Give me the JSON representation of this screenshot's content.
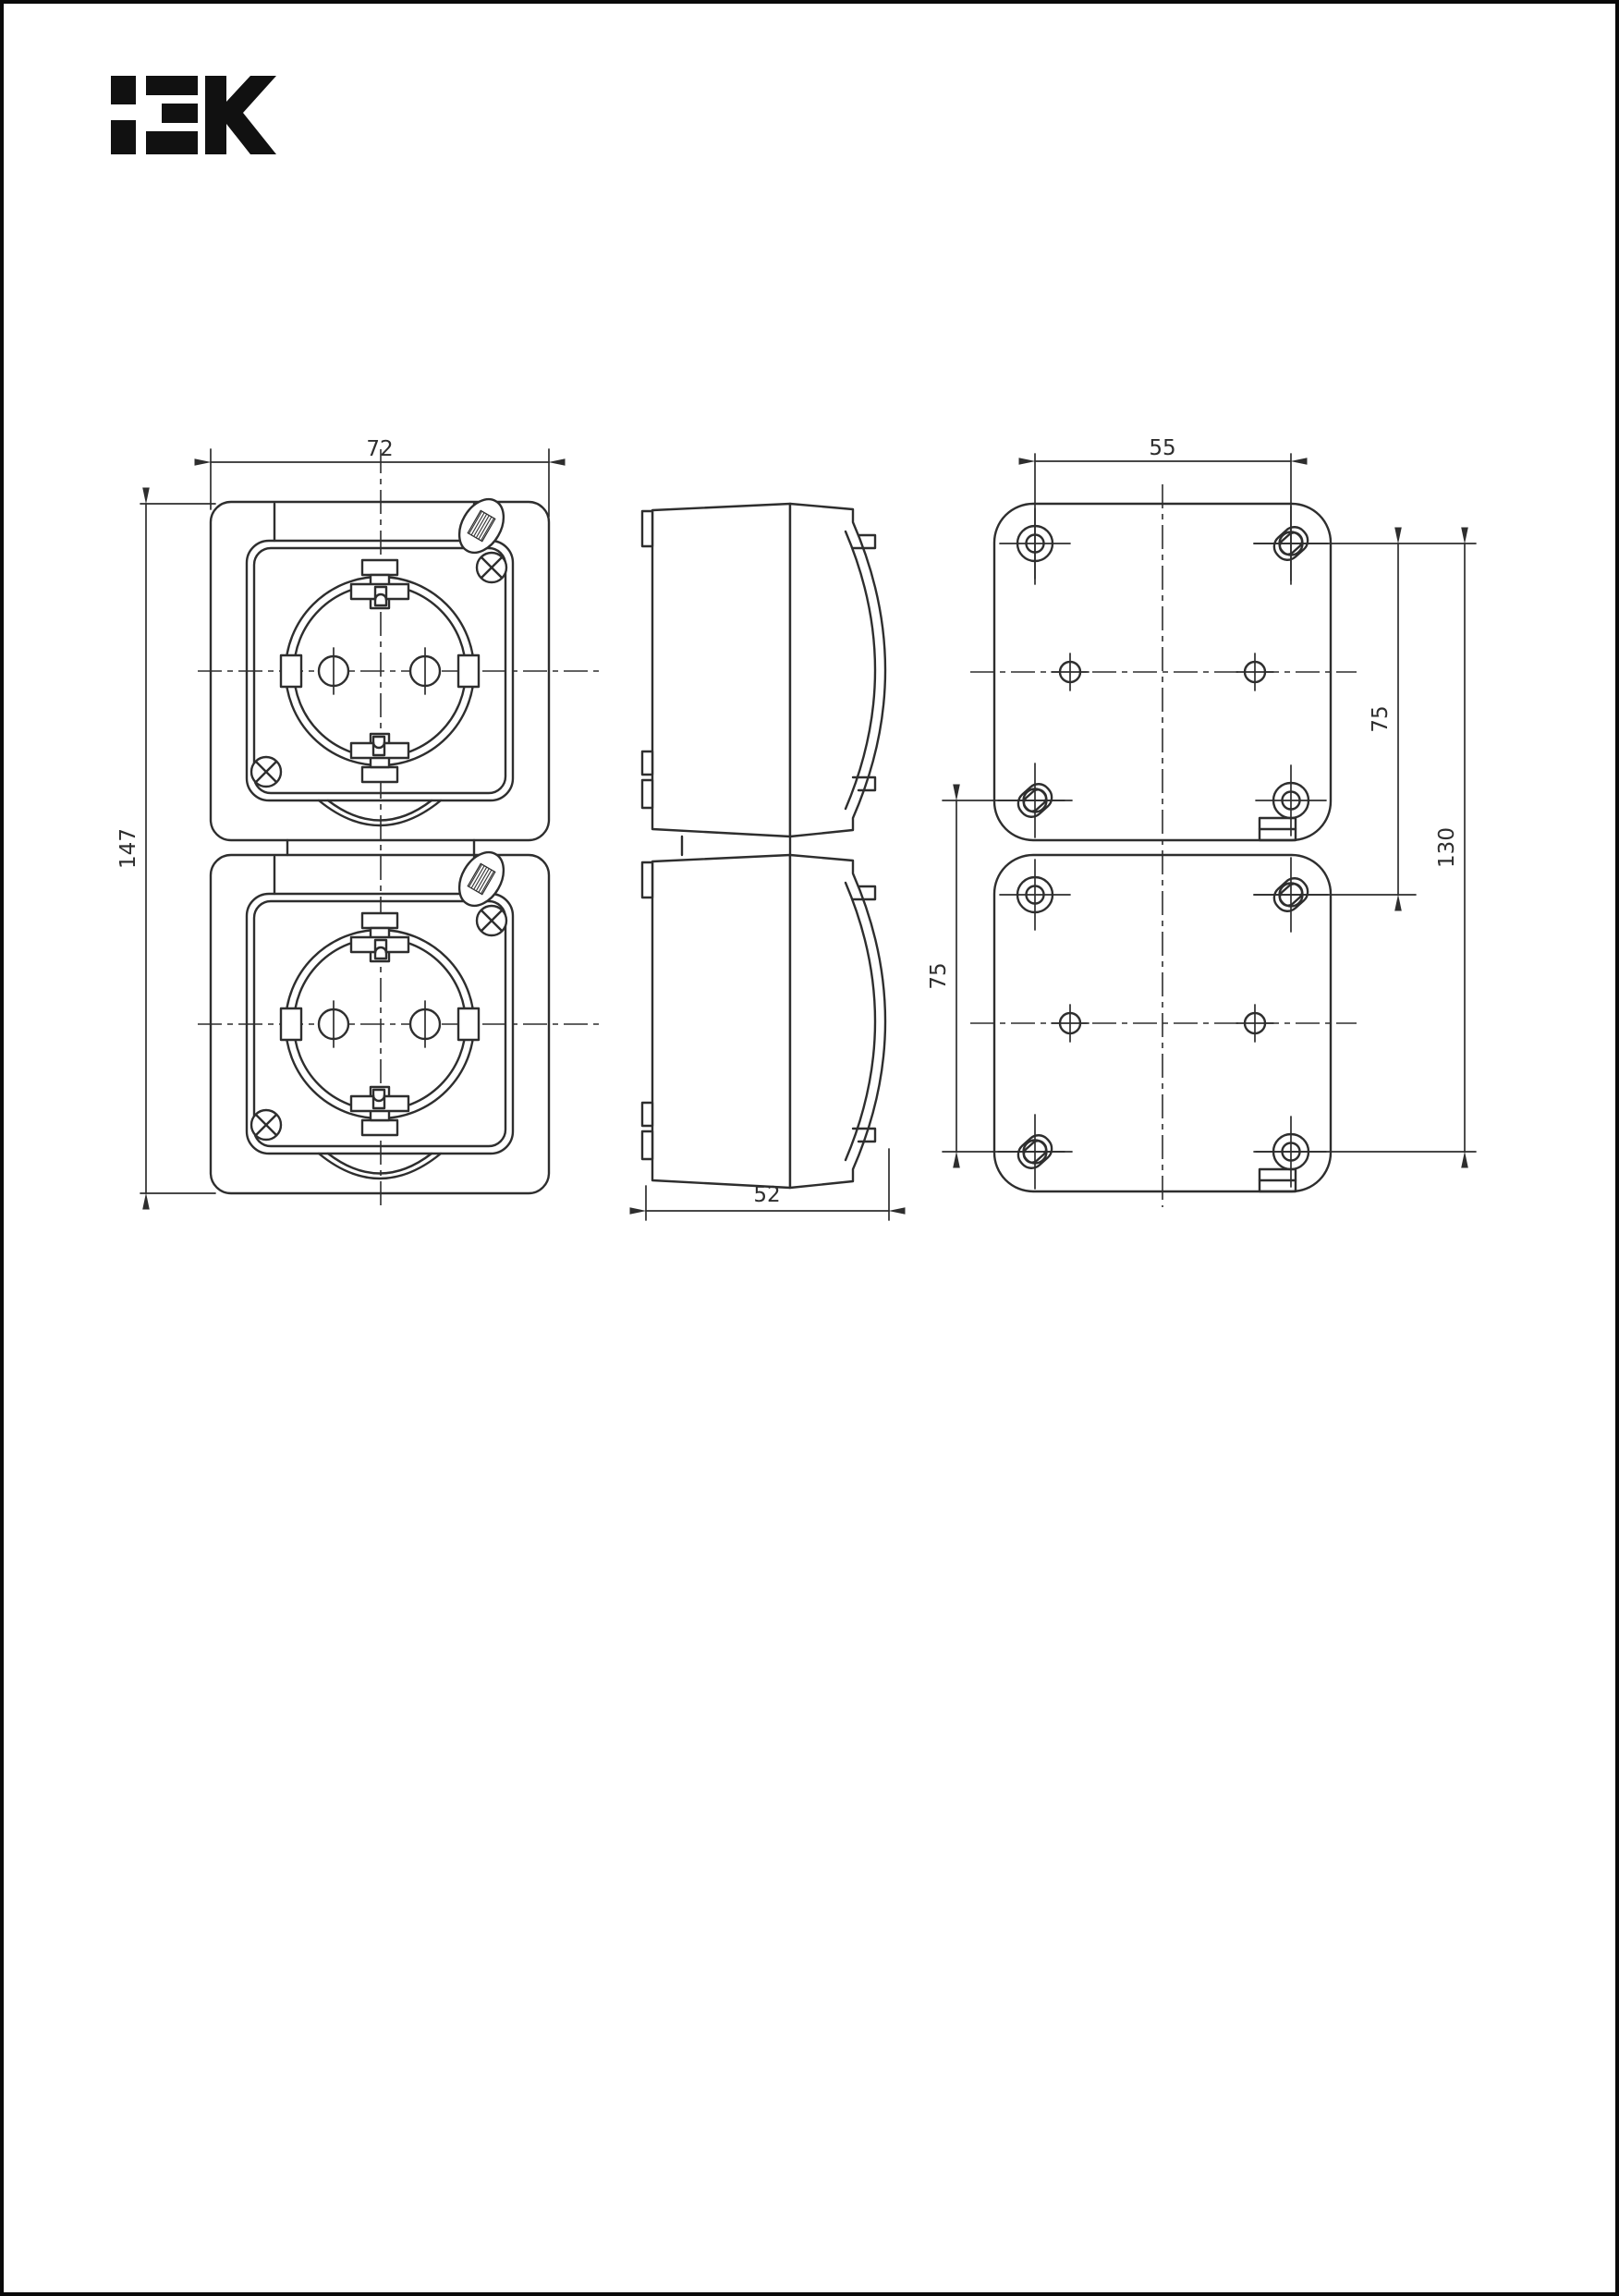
{
  "page": {
    "background": "#ffffff",
    "border_color": "#0a0a0a",
    "line_color": "#2e2e2e"
  },
  "logo": {
    "brand": "IEK",
    "color": "#111111"
  },
  "drawing": {
    "front_view": {
      "width_mm": "72",
      "height_mm": "147"
    },
    "side_view": {
      "depth_mm": "52"
    },
    "back_view": {
      "hole_spacing_mm": "55",
      "left_vertical_mm": "75",
      "right_vertical_mm": "75",
      "overall_vertical_mm": "130"
    }
  }
}
